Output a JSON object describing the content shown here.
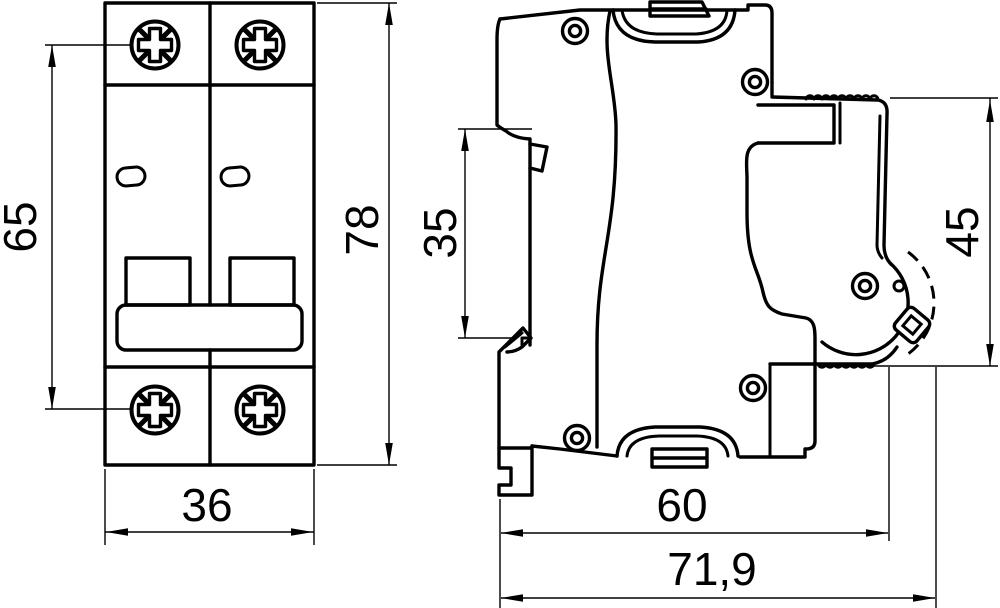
{
  "drawing": {
    "background": "#ffffff",
    "line_color": "#000000",
    "views": {
      "front": {
        "name": "front-view"
      },
      "side": {
        "name": "side-view"
      }
    },
    "dimensions": {
      "mounting_hole_span": "65",
      "front_height": "78",
      "front_width": "36",
      "din_recess_height": "35",
      "side_height": "45",
      "body_depth": "60",
      "total_depth": "71,9"
    }
  }
}
